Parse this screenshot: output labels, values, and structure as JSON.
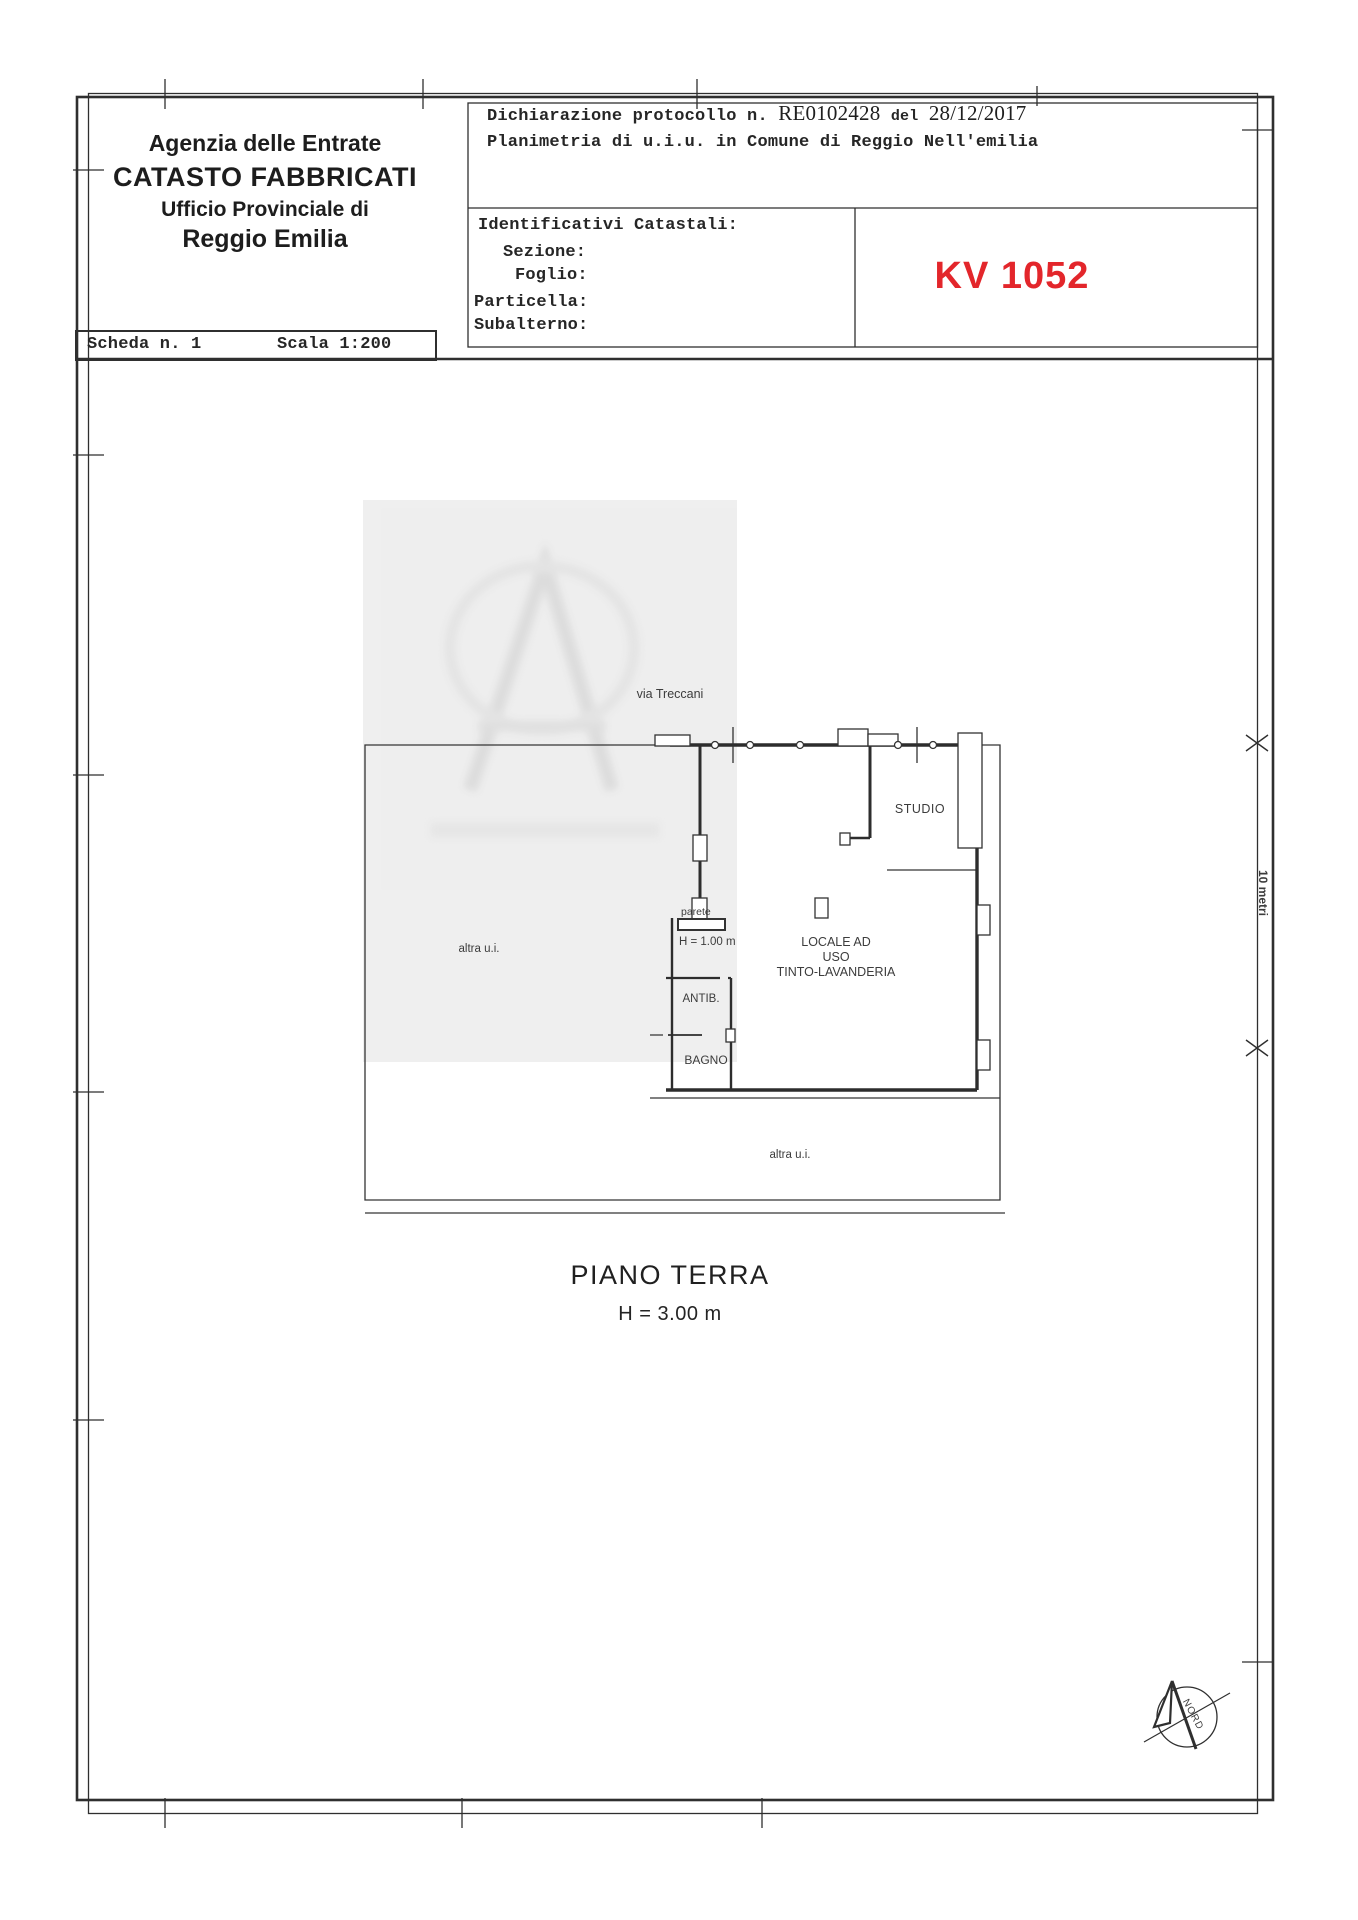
{
  "document": {
    "agency": {
      "line1": "Agenzia delle Entrate",
      "line2": "CATASTO FABBRICATI",
      "line3": "Ufficio Provinciale di",
      "line4": "Reggio Emilia"
    },
    "declaration": {
      "prefix": "Dichiarazione protocollo n.",
      "protocol": "RE0102428",
      "del": "del",
      "date": "28/12/2017",
      "subject": "Planimetria di u.i.u. in Comune di Reggio Nell'emilia"
    },
    "identifiers": {
      "title": "Identificativi Catastali:",
      "sezione": "Sezione:",
      "foglio": "Foglio:",
      "particella": "Particella:",
      "subalterno": "Subalterno:"
    },
    "code": "KV 1052",
    "code_color": "#e3262b",
    "scheda": "Scheda n. 1",
    "scala": "Scala 1:200"
  },
  "plan": {
    "street": "via Treccani",
    "room_studio": "STUDIO",
    "room_locale_line1": "LOCALE AD",
    "room_locale_line2": "USO",
    "room_locale_line3": "TINTO-LAVANDERIA",
    "room_antib": "ANTIB.",
    "room_bagno": "BAGNO",
    "parete": "parete",
    "parete_height": "H = 1.00 m",
    "altra_ui_left": "altra u.i.",
    "altra_ui_bottom": "altra u.i.",
    "dimension": "10 metri",
    "north": "NORD",
    "floor_title": "PIANO TERRA",
    "floor_height": "H = 3.00 m"
  }
}
